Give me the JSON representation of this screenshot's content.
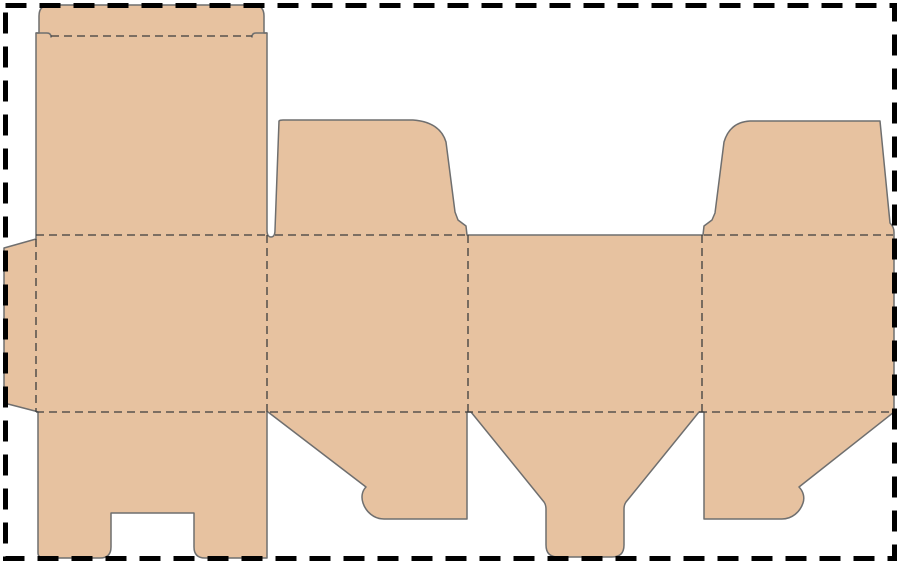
{
  "canvas": {
    "width": 900,
    "height": 564,
    "background": "#ffffff"
  },
  "page_border": {
    "inset": 5.5,
    "color": "#000000",
    "stroke_width": 5,
    "dash": "21 13"
  },
  "dieline": {
    "material_fill": "#e7c2a0",
    "cut_color": "#6f6f6f",
    "cut_width": 1.5,
    "fold_color": "#3d3d3d",
    "fold_width": 1.3,
    "fold_dash": "8 5",
    "blank_outline_path": "M36,33 L39,33 L39,16 Q39,5 50,5 L253,5 Q264,5 264,16 L264,33 L267,33 L267,230 Q267,237 271,237 Q275,237 275,230 L279,121 Q280,120 283,120 L413,120 Q440,122 446,142 L455,212 L458,220 L466,226 L467,235 L703,235 L704,226 L712,220 L715,213 L724,142 Q730,122 750,121 L880,121 L890,223 Q894,227 894,232 L894,412 L799,487 C803,491 805,497 803,503 C800,512 792,519 782,519 L704,519 L704,412 L699,412 L626,502 Q624,505 624,509 L624,545 Q624,557 612,557 L558,557 Q546,557 546,545 L546,509 Q546,505 544,502 L471,412 L467,412 L467,519 L384,519 C374,519 366,512 363,503 C361,497 362,491 366,487 L268,412 L267,412 L267,558 L205,558 Q194,558 194,547 L194,513 L111,513 L111,547 Q111,558 100,558 L45,558 Q38,558 38,553 L38,412 L35,411 L4,403 L4,248 L36,239 Z",
    "internal_cuts": [
      {
        "name": "tuck-lock-slit-left",
        "path": "M36,33 L47,33 Q51,33 51,37"
      },
      {
        "name": "tuck-lock-slit-right",
        "path": "M267,33 L256,33 Q252,33 252,37"
      }
    ],
    "fold_lines": [
      {
        "name": "tuck-flap-fold",
        "x1": 51,
        "y1": 36,
        "x2": 252,
        "y2": 36
      },
      {
        "name": "lid-panel-top-fold",
        "x1": 36,
        "y1": 235,
        "x2": 267,
        "y2": 235
      },
      {
        "name": "dust-flap-left-top-fold",
        "x1": 275,
        "y1": 235,
        "x2": 467,
        "y2": 235
      },
      {
        "name": "dust-flap-right-top-fold",
        "x1": 704,
        "y1": 235,
        "x2": 893,
        "y2": 235
      },
      {
        "name": "bottom-flaps-fold",
        "x1": 36,
        "y1": 412,
        "x2": 894,
        "y2": 412
      },
      {
        "name": "glue-flap-fold",
        "x1": 36,
        "y1": 239,
        "x2": 36,
        "y2": 412
      },
      {
        "name": "panel-fold-1",
        "x1": 267,
        "y1": 235,
        "x2": 267,
        "y2": 412
      },
      {
        "name": "panel-fold-2",
        "x1": 468,
        "y1": 235,
        "x2": 468,
        "y2": 412
      },
      {
        "name": "panel-fold-3",
        "x1": 702,
        "y1": 235,
        "x2": 702,
        "y2": 412
      }
    ]
  }
}
